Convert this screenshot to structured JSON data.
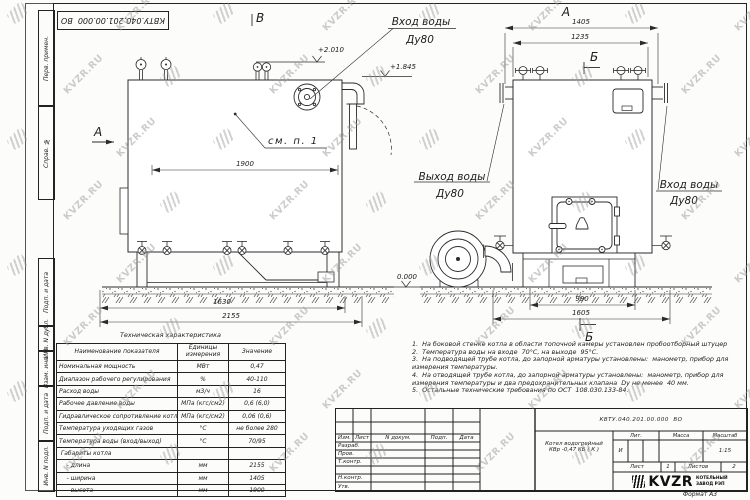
{
  "watermark": {
    "text": "KVZR.RU"
  },
  "top_stamp": {
    "doc_number": "КВТУ.040.201.00.000  ВО"
  },
  "margin_labels": [
    "Перв. примен.",
    "Справ. №",
    "Подп. и дата",
    "Инв. N дубл.",
    "Взам. инв. N",
    "Подп. и дата",
    "Инв. N подл."
  ],
  "views": {
    "left": {
      "view_label": "А",
      "section_label_top": "В",
      "callout": "см. п. 1",
      "inlet_line1": "Вход воды",
      "inlet_line2": "Ду80",
      "elev_top": "+2.010",
      "elev_mid": "+1.845",
      "elev_zero": "0.000",
      "dim_1900": "1900",
      "dim_1630": "1630",
      "dim_2155": "2155"
    },
    "right": {
      "view_label": "А",
      "section_label_top": "Б",
      "section_label_bottom": "Б",
      "outlet_line1": "Выход воды",
      "outlet_line2": "Ду80",
      "inlet_line1": "Вход воды",
      "inlet_line2": "Ду80",
      "dim_1405": "1405",
      "dim_1235": "1235",
      "dim_990": "990",
      "dim_1605": "1605"
    }
  },
  "notes": {
    "lines": [
      "1.  На боковой стенке котла в области топочной камеры установлен пробоотборный штуцер",
      "2.  Температура воды на входе  70°С, на выходе  95°С.",
      "3.  На подводящей трубе котла, до запорной арматуры установлены:  манометр, прибор для",
      "измерения температуры.",
      "4.  На отводящей трубе котла, до запорной арматуры установлены:  манометр, прибор для",
      "измерения температуры и два предохранительных клапана  Dу не менее  40 мм.",
      "5.  Остальные технические требования по ОСТ  108.030.133-84."
    ]
  },
  "tech_table": {
    "title": "Техническая характеристика",
    "headers": [
      "Наименование показателя",
      "Единицы измерения",
      "Значение"
    ],
    "rows": [
      [
        "Номинальная мощность",
        "МВт",
        "0,47"
      ],
      [
        "Диапазон рабочего регулирования",
        "%",
        "40-110"
      ],
      [
        "Расход воды",
        "м3/ч",
        "16"
      ],
      [
        "Рабочее давление воды",
        "МПа (кгс/см2)",
        "0,6 (6,0)"
      ],
      [
        "Гидравлическое сопротивление котла",
        "МПа (кгс/см2)",
        "0,06 (0,6)"
      ],
      [
        "Температура уходящих газов",
        "°С",
        "не более 280"
      ],
      [
        "Температура воды (вход/выход)",
        "°С",
        "70/95"
      ],
      [
        " Габариты котла",
        "",
        ""
      ],
      [
        "    - длина",
        "мм",
        "2155"
      ],
      [
        "    - ширина",
        "мм",
        "1405"
      ],
      [
        "    - высота",
        "мм",
        "1900"
      ]
    ]
  },
  "title_block": {
    "doc_number": "КВТУ.040.201.00.000  ВО",
    "product_line1": "Котел водогрейный",
    "product_line2": "КВр -0,47 КБ ( К )",
    "cols": {
      "izm": "Изм.",
      "list": "Лист",
      "ndoc": "N докум.",
      "podp": "Подп.",
      "data": "Дата"
    },
    "rows": {
      "razrab": "Разраб.",
      "prov": "Пров.",
      "tkontr": "Т.контр.",
      "nkontr": "Н.контр.",
      "utv": "Утв."
    },
    "lit": {
      "header": "Лит.",
      "value": "И"
    },
    "massa": {
      "header": "Масса"
    },
    "scale": {
      "header": "Масштаб",
      "value": "1:15"
    },
    "sheet": {
      "label": "Лист",
      "value": "1"
    },
    "sheets": {
      "label": "Листов",
      "value": "2"
    },
    "logo": {
      "brand": "KVZR",
      "sub1": "КОТЕЛЬНЫЙ",
      "sub2": "ЗАВОД РЭП"
    },
    "format": "Формат  А3"
  }
}
